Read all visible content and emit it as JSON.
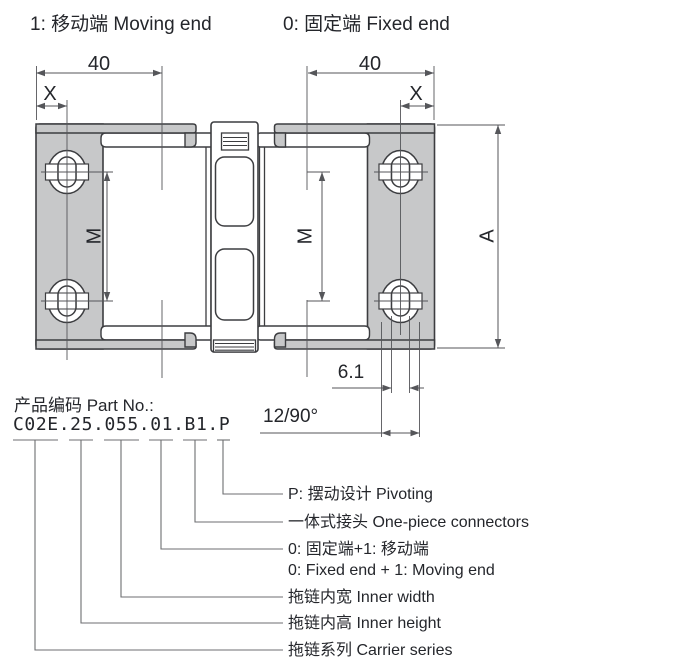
{
  "title_labels": {
    "moving_end": "1: 移动端 Moving end",
    "fixed_end": "0: 固定端 Fixed end"
  },
  "drawing": {
    "colors": {
      "bracket_fill": "#c7c8c9",
      "outline": "#3c3d40",
      "dim_lines": "#55565a",
      "dim_text": "#24262b"
    },
    "dims": {
      "width_left": "40",
      "width_right": "40",
      "offset_left": "X",
      "offset_right": "X",
      "hole_pitch_left": "M",
      "hole_pitch_right": "M",
      "overall_height": "A",
      "slot_width": "6.1",
      "link_pitch": "12/90°"
    }
  },
  "part_number": {
    "label": "产品编码 Part No.:",
    "code": "C02E.25.055.01.B1.P",
    "breakdown": [
      {
        "code": "P",
        "label": "P: 摆动设计 Pivoting"
      },
      {
        "code": "B1",
        "label": "一体式接头 One-piece connectors"
      },
      {
        "code": "01",
        "label": "0: 固定端+1: 移动端",
        "label_en": "0: Fixed end + 1: Moving end"
      },
      {
        "code": "055",
        "label": "拖链内宽 Inner width"
      },
      {
        "code": "25",
        "label": "拖链内高 Inner height"
      },
      {
        "code": "C02E",
        "label": "拖链系列 Carrier series"
      }
    ]
  }
}
